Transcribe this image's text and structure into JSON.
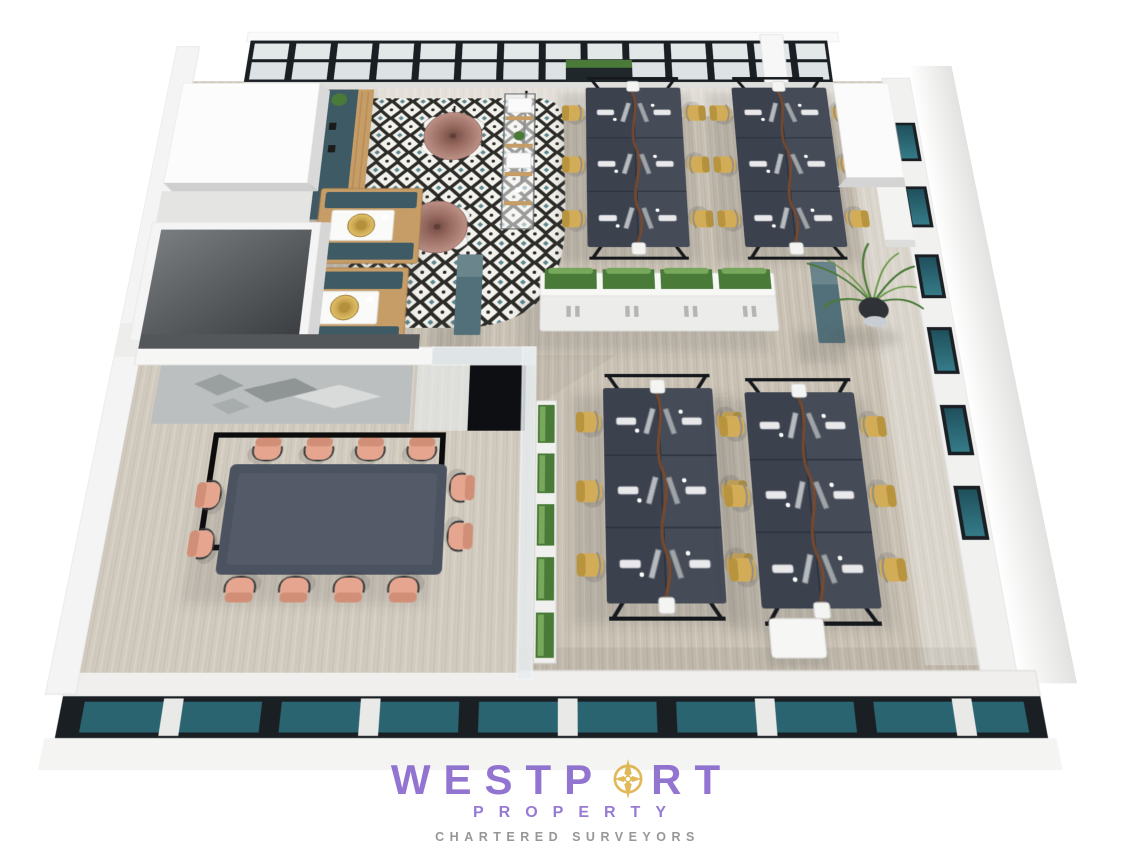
{
  "watermark": {
    "brand_prefix": "WESTP",
    "brand_suffix": "RT",
    "brand_word": "WESTPORT",
    "subtitle": "PROPERTY",
    "tagline": "CHARTERED SURVEYORS"
  },
  "colors": {
    "brand-purple": "#7a57c7",
    "compass-gold": "#d9a62b",
    "tagline-gray": "#8f8f8f",
    "floor-wood": "#cbc3b5",
    "tile-white": "#f4f2ec",
    "tile-black": "#2b2b28",
    "tile-teal": "#5d8791",
    "desk-navy": "#3b424e",
    "chair-yellow": "#d3ac57",
    "chair-salmon": "#e5a58e",
    "meeting-table-navy": "#4b5260",
    "divider-teal": "#52707a",
    "booth-teal": "#3e5a64",
    "booth-wood": "#c69d66",
    "lamp-rose": "#a97c71",
    "lamp-brass": "#c5a04a",
    "glass-teal": "#2a6470",
    "plant-green": "#4a7a38",
    "frame-black": "#1a1f24",
    "wall-white": "#f4f4f3"
  },
  "scene": {
    "description": "3D rendered office floor plan viewed from above",
    "workstation_clusters": 4,
    "desks_per_cluster": 6,
    "desk_chairs_total": 24,
    "meeting_room_seats": 12,
    "cafe_tables": 2,
    "booths": 2
  }
}
